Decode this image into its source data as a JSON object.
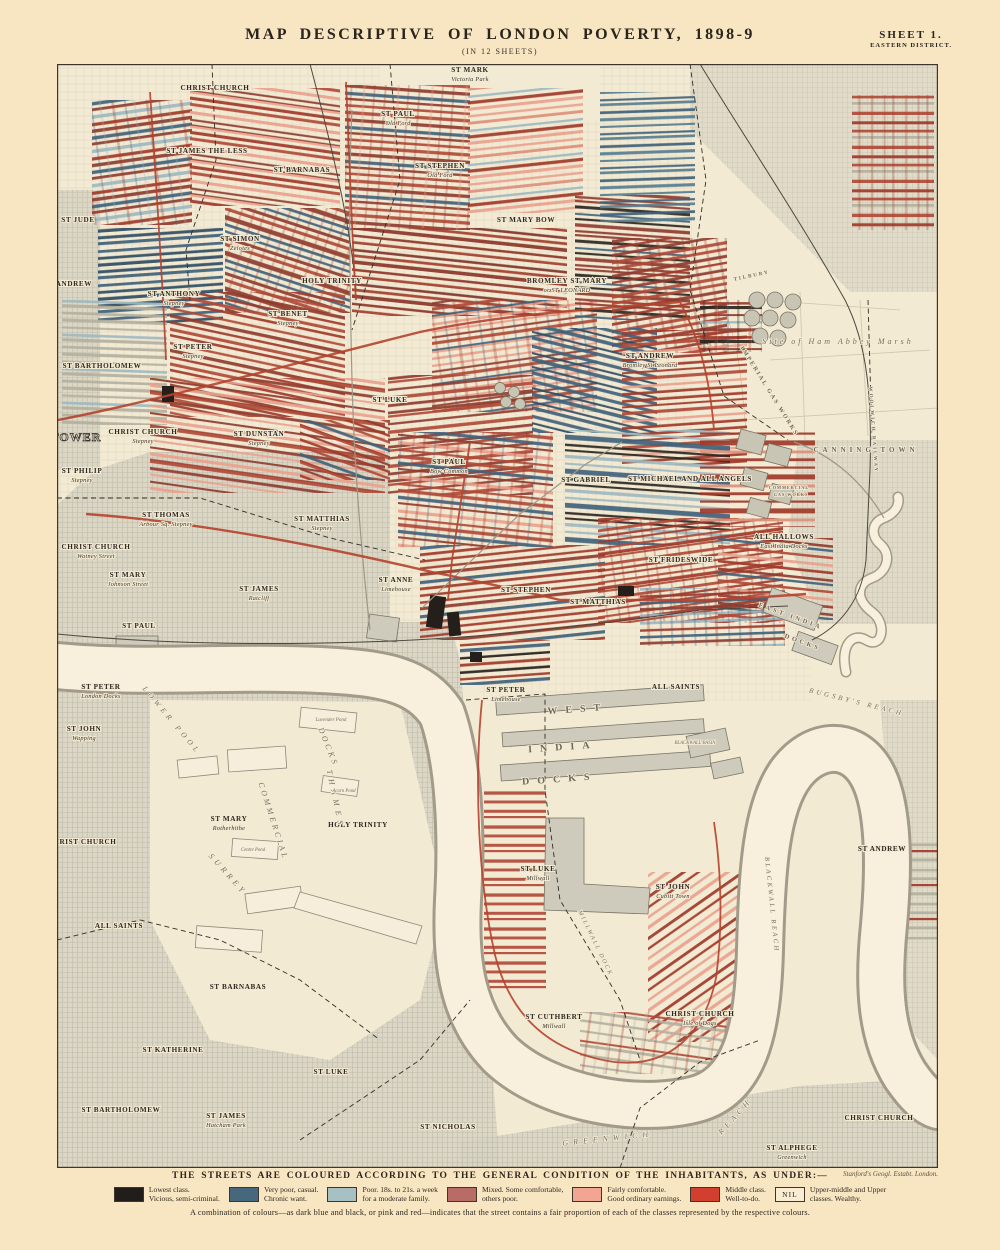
{
  "page": {
    "title": "MAP DESCRIPTIVE OF LONDON POVERTY, 1898-9",
    "subtitle": "(IN 12 SHEETS)",
    "sheet_label": "SHEET 1.",
    "sheet_sublabel": "EASTERN DISTRICT.",
    "imprint": "Stanford's Geogl. Estabt. London."
  },
  "legend": {
    "heading": "THE STREETS ARE COLOURED ACCORDING TO THE GENERAL CONDITION OF THE INHABITANTS, AS UNDER:—",
    "items": [
      {
        "color": "#211d1a",
        "line1": "Lowest class.",
        "line2": "Vicious, semi-criminal."
      },
      {
        "color": "#45687c",
        "line1": "Very poor, casual.",
        "line2": "Chronic want."
      },
      {
        "color": "#a7c0c4",
        "line1": "Poor. 18s. to 21s. a week",
        "line2": "for a moderate family."
      },
      {
        "color": "#b96b68",
        "line1": "Mixed. Some comfortable,",
        "line2": "others poor."
      },
      {
        "color": "#f1a592",
        "line1": "Fairly comfortable.",
        "line2": "Good ordinary earnings."
      },
      {
        "color": "#d23f2e",
        "line1": "Middle class.",
        "line2": "Well-to-do."
      },
      {
        "nil": true,
        "nil_label": "NIL",
        "line1": "Upper-middle and Upper",
        "line2": "classes. Wealthy."
      }
    ],
    "note": "A combination of colours—as dark blue and black, or pink and red—indicates that the street contains a fair proportion of each of the classes represented by the respective colours."
  },
  "map": {
    "labels": [
      {
        "t": "CHRIST CHURCH",
        "x": 215,
        "y": 90
      },
      {
        "t": "ST MARK",
        "sub": "Victoria Park",
        "x": 470,
        "y": 72
      },
      {
        "t": "ST JAMES THE LESS",
        "x": 207,
        "y": 153
      },
      {
        "t": "ST BARNABAS",
        "x": 302,
        "y": 172
      },
      {
        "t": "ST PAUL",
        "sub": "Old Ford",
        "x": 398,
        "y": 116
      },
      {
        "t": "ST STEPHEN",
        "sub": "Old Ford",
        "x": 440,
        "y": 168
      },
      {
        "t": "ST JUDE",
        "x": 78,
        "y": 222
      },
      {
        "t": "ST SIMON",
        "sub": "Zelotes",
        "x": 240,
        "y": 241
      },
      {
        "t": "ST MARY BOW",
        "x": 526,
        "y": 222
      },
      {
        "t": "ST ANDREW",
        "x": 68,
        "y": 286
      },
      {
        "t": "ST ANTHONY",
        "sub": "Stepney",
        "x": 174,
        "y": 296
      },
      {
        "t": "HOLY TRINITY",
        "x": 332,
        "y": 283
      },
      {
        "t": "BROMLEY ST MARY",
        "sub": "or ST LEONARD",
        "x": 567,
        "y": 283
      },
      {
        "t": "ST BENET",
        "sub": "Stepney",
        "x": 288,
        "y": 316
      },
      {
        "t": "ST PETER",
        "sub": "Stepney",
        "x": 193,
        "y": 349
      },
      {
        "t": "ST BARTHOLOMEW",
        "x": 102,
        "y": 368
      },
      {
        "t": "ST ANDREW",
        "sub": "Bromley St Leonard",
        "x": 650,
        "y": 358
      },
      {
        "t": "CHRIST CHURCH",
        "sub": "Stepney",
        "x": 143,
        "y": 434
      },
      {
        "t": "ST DUNSTAN",
        "sub": "Stepney",
        "x": 259,
        "y": 436
      },
      {
        "t": "ST LUKE",
        "x": 390,
        "y": 402
      },
      {
        "t": "ST PAUL",
        "sub": "Bow Common",
        "x": 449,
        "y": 464
      },
      {
        "t": "ST GABRIEL",
        "x": 586,
        "y": 482
      },
      {
        "t": "ST MICHAEL AND ALL ANGELS",
        "x": 690,
        "y": 481
      },
      {
        "t": "ST PHILIP",
        "sub": "Stepney",
        "x": 82,
        "y": 473
      },
      {
        "t": "ST THOMAS",
        "sub": "Arbour Sq. Stepney",
        "x": 166,
        "y": 517
      },
      {
        "t": "ST MATTHIAS",
        "sub": "Stepney",
        "x": 322,
        "y": 521
      },
      {
        "t": "CHRIST CHURCH",
        "sub": "Watney Street",
        "x": 96,
        "y": 549
      },
      {
        "t": "ST MARY",
        "sub": "Johnson Street",
        "x": 128,
        "y": 577
      },
      {
        "t": "ST JAMES",
        "sub": "Ratcliff",
        "x": 259,
        "y": 591
      },
      {
        "t": "ST ANNE",
        "sub": "Limehouse",
        "x": 396,
        "y": 582
      },
      {
        "t": "ST STEPHEN",
        "x": 526,
        "y": 592
      },
      {
        "t": "ST MATTHIAS",
        "x": 598,
        "y": 604
      },
      {
        "t": "ST FRIDESWIDE",
        "x": 681,
        "y": 562
      },
      {
        "t": "ALL HALLOWS",
        "sub": "East India Docks",
        "x": 784,
        "y": 539
      },
      {
        "t": "ST PAUL",
        "x": 139,
        "y": 628
      },
      {
        "t": "ST PETER",
        "sub": "London Docks",
        "x": 101,
        "y": 689
      },
      {
        "t": "ST JOHN",
        "sub": "Wapping",
        "x": 84,
        "y": 731
      },
      {
        "t": "ST PETER",
        "sub": "Limehouse",
        "x": 506,
        "y": 692
      },
      {
        "t": "ALL SAINTS",
        "x": 676,
        "y": 689
      },
      {
        "t": "CHRIST CHURCH",
        "x": 82,
        "y": 844
      },
      {
        "t": "ST MARY",
        "sub": "Rotherhithe",
        "x": 229,
        "y": 821
      },
      {
        "t": "HOLY TRINITY",
        "x": 358,
        "y": 827
      },
      {
        "t": "ST LUKE",
        "sub": "Millwall",
        "x": 538,
        "y": 871
      },
      {
        "t": "ST JOHN",
        "sub": "Cubitt Town",
        "x": 673,
        "y": 889
      },
      {
        "t": "ST ANDREW",
        "x": 882,
        "y": 851
      },
      {
        "t": "ALL SAINTS",
        "x": 119,
        "y": 928
      },
      {
        "t": "ST BARNABAS",
        "x": 238,
        "y": 989
      },
      {
        "t": "ST KATHERINE",
        "x": 173,
        "y": 1052
      },
      {
        "t": "ST LUKE",
        "x": 331,
        "y": 1074
      },
      {
        "t": "ST CUTHBERT",
        "sub": "Millwall",
        "x": 554,
        "y": 1019
      },
      {
        "t": "CHRIST CHURCH",
        "sub": "Isle of Dogs",
        "x": 700,
        "y": 1016
      },
      {
        "t": "ST BARTHOLOMEW",
        "x": 121,
        "y": 1112
      },
      {
        "t": "ST JAMES",
        "sub": "Hatcham Park",
        "x": 226,
        "y": 1118
      },
      {
        "t": "ST NICHOLAS",
        "x": 448,
        "y": 1129
      },
      {
        "t": "ST ALPHEGE",
        "sub": "Greenwich",
        "x": 792,
        "y": 1150
      },
      {
        "t": "CHRIST CHURCH",
        "x": 879,
        "y": 1120
      },
      {
        "t": "TOWER",
        "x": 76,
        "y": 441,
        "k": "outline",
        "s": 12
      },
      {
        "t": "CANNING TOWN",
        "x": 866,
        "y": 452,
        "k": "town",
        "s": 7,
        "sp": 4
      },
      {
        "t": "Site of Ham Abbey Marsh",
        "x": 838,
        "y": 344,
        "k": "wit",
        "s": 8,
        "sp": 3
      },
      {
        "t": "IMPERIAL GAS WORKS",
        "x": 768,
        "y": 392,
        "k": "town",
        "s": 6,
        "sp": 2,
        "r": 58
      },
      {
        "t": "COMMERCIAL",
        "x": 789,
        "y": 489,
        "k": "town",
        "s": 4.2,
        "sp": 1
      },
      {
        "t": "GAS WORKS",
        "x": 791,
        "y": 496,
        "k": "town",
        "s": 4.2,
        "sp": 1
      },
      {
        "t": "WEST",
        "x": 578,
        "y": 712,
        "k": "area",
        "s": 10,
        "sp": 8,
        "r": -4
      },
      {
        "t": "INDIA",
        "x": 563,
        "y": 750,
        "k": "area",
        "s": 10,
        "sp": 8,
        "r": -4
      },
      {
        "t": "DOCKS",
        "x": 560,
        "y": 782,
        "k": "area",
        "s": 10,
        "sp": 8,
        "r": -4
      },
      {
        "t": "EAST INDIA",
        "x": 790,
        "y": 618,
        "k": "town",
        "s": 6.5,
        "sp": 3,
        "r": 20
      },
      {
        "t": "DOCKS",
        "x": 802,
        "y": 644,
        "k": "town",
        "s": 6.5,
        "sp": 3,
        "r": 20
      },
      {
        "t": "LOWER POOL",
        "x": 170,
        "y": 722,
        "k": "wit",
        "s": 7.5,
        "sp": 4,
        "r": 50
      },
      {
        "t": "THAMES",
        "x": 333,
        "y": 800,
        "k": "wit",
        "s": 8,
        "sp": 5,
        "r": 78
      },
      {
        "t": "SURREY",
        "x": 226,
        "y": 876,
        "k": "wit",
        "s": 8,
        "sp": 4,
        "r": 48
      },
      {
        "t": "COMMERCIAL",
        "x": 271,
        "y": 822,
        "k": "wit",
        "s": 8,
        "sp": 3,
        "r": 72
      },
      {
        "t": "DOCKS",
        "x": 326,
        "y": 748,
        "k": "wit",
        "s": 8,
        "sp": 3,
        "r": 68
      },
      {
        "t": "GREENWICH",
        "x": 608,
        "y": 1141,
        "k": "wit",
        "s": 8,
        "sp": 5,
        "r": -6
      },
      {
        "t": "REACH",
        "x": 737,
        "y": 1118,
        "k": "wit",
        "s": 8,
        "sp": 4,
        "r": -48
      },
      {
        "t": "BUGSBY'S REACH",
        "x": 856,
        "y": 704,
        "k": "wit",
        "s": 7,
        "sp": 3,
        "r": 14
      },
      {
        "t": "BLACKWALL REACH",
        "x": 770,
        "y": 905,
        "k": "wit",
        "s": 6.5,
        "sp": 2.5,
        "r": 84
      },
      {
        "t": "MILLWALL DOCK",
        "x": 594,
        "y": 944,
        "k": "wit",
        "s": 6,
        "sp": 2,
        "r": 64
      },
      {
        "t": "BLACKWALL BASIN",
        "x": 695,
        "y": 744,
        "k": "wit",
        "s": 4.8
      },
      {
        "t": "Lavender Pond",
        "x": 331,
        "y": 721,
        "k": "wit",
        "s": 5
      },
      {
        "t": "Acorn Pond",
        "x": 344,
        "y": 792,
        "k": "wit",
        "s": 4.8
      },
      {
        "t": "Centre Pond",
        "x": 253,
        "y": 851,
        "k": "wit",
        "s": 4.8
      },
      {
        "t": "WOOLWICH RAILWAY",
        "x": 872,
        "y": 430,
        "k": "town",
        "s": 5,
        "sp": 2,
        "r": 86
      },
      {
        "t": "TILBURY",
        "x": 752,
        "y": 277,
        "k": "town",
        "s": 5,
        "sp": 2,
        "r": -12
      }
    ]
  }
}
